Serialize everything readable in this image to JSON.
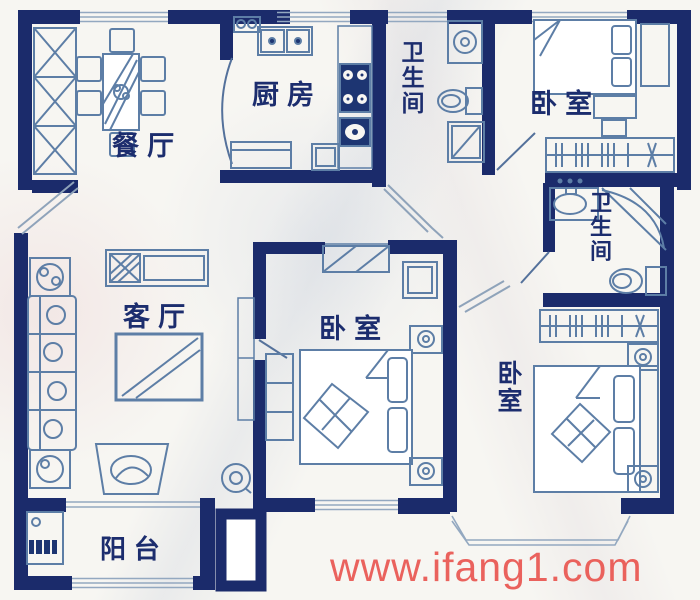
{
  "plan": {
    "title": "apartment floor plan",
    "rooms": {
      "dining": {
        "label": "餐厅"
      },
      "kitchen": {
        "label": "厨房"
      },
      "bath_top": {
        "label": "卫生间"
      },
      "bedroom_top_right": {
        "label": "卧室"
      },
      "bath_right": {
        "label": "卫生间"
      },
      "bedroom_middle": {
        "label": "卧室"
      },
      "bedroom_bottom": {
        "label": "卧室"
      },
      "living": {
        "label": "客厅"
      },
      "balcony": {
        "label": "阳台"
      }
    }
  },
  "watermark": {
    "text": "www.ifang1.com",
    "color": "#e84d48"
  },
  "colors": {
    "wall": "#1b2b6b",
    "furniture_line": "#5d7ea6",
    "fixture_fill": "#1d3572",
    "window_line": "#93a8c0",
    "label_text": "#1c2d6e",
    "background": "#f7f6f2"
  }
}
